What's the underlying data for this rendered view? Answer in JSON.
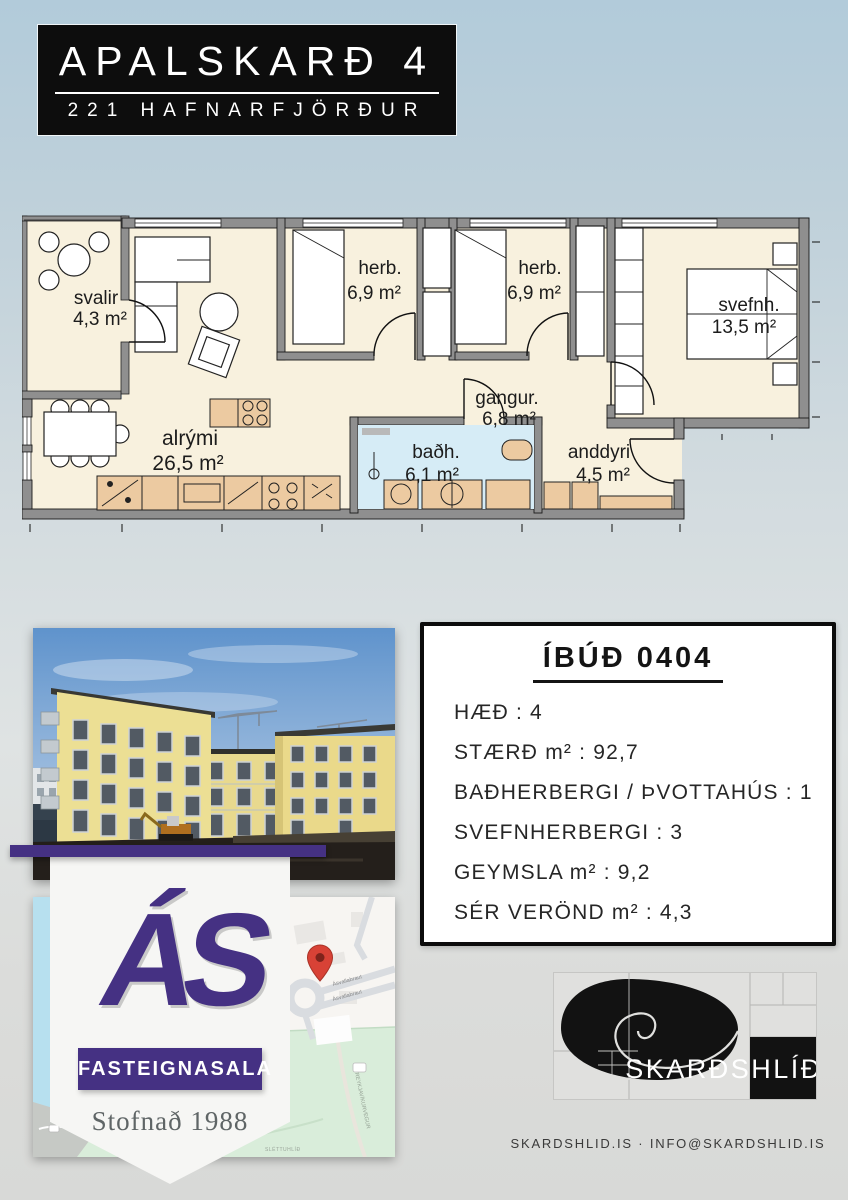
{
  "header": {
    "title": "APALSKARÐ 4",
    "subtitle": "221 HAFNARFJÖRÐUR"
  },
  "floorplan": {
    "rooms": [
      {
        "name": "svalir",
        "area": "4,3 m²"
      },
      {
        "name": "alrými",
        "area": "26,5 m²"
      },
      {
        "name": "herb.",
        "area": "6,9 m²"
      },
      {
        "name": "herb.",
        "area": "6,9 m²"
      },
      {
        "name": "svefnh.",
        "area": "13,5 m²"
      },
      {
        "name": "gangur.",
        "area": "6,8 m²"
      },
      {
        "name": "baðh.",
        "area": "6,1 m²"
      },
      {
        "name": "anddyri",
        "area": "4,5 m²"
      }
    ]
  },
  "info_card": {
    "title": "ÍBÚÐ 0404",
    "rows": [
      "HÆÐ : 4",
      "STÆRÐ m² : 92,7",
      "BAÐHERBERGI / ÞVOTTAHÚS : 1",
      "SVEFNHERBERGI : 3",
      "GEYMSLA m² : 9,2",
      "SÉR VERÖND m² : 4,3"
    ]
  },
  "agency": {
    "logo_text": "ÁS",
    "banner_label": "FASTEIGNASALA",
    "tagline": "Stofnað 1988",
    "brand_color": "#453183"
  },
  "map": {
    "labels": [
      "Ásvallabraut",
      "Ásvallabraut",
      "REYKJAVÍKURVEGUR",
      "SLÉTTUHLÍÐ"
    ]
  },
  "developer": {
    "logo_text": "SKARÐSHLÍÐ"
  },
  "footer": {
    "contact": "SKARDSHLID.IS · INFO@SKARDSHLID.IS"
  },
  "colors": {
    "brand_purple": "#453183",
    "header_black": "#0d0d0d",
    "plan_floor": "#f8f1de",
    "plan_wall": "#8f8f8f",
    "plan_furniture": "#eccaa1",
    "bath_floor": "#d6ecf6",
    "map_green": "#d9edda",
    "map_water": "#b7e0ef",
    "pin_red": "#d84236"
  }
}
